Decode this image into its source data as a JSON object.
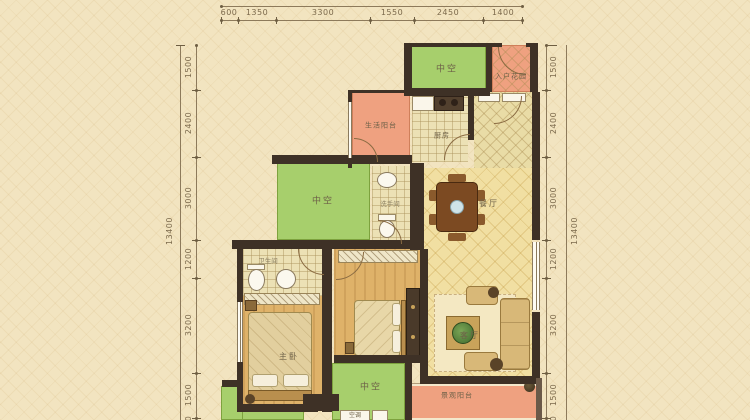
{
  "plan": {
    "dims": {
      "top": [
        "600",
        "1350",
        "3300",
        "1550",
        "2450",
        "1400"
      ],
      "left_total": "13400",
      "right_total": "13400",
      "left": [
        "1500",
        "2400",
        "3000",
        "1200",
        "3200",
        "1500",
        "600"
      ],
      "right": [
        "1500",
        "2400",
        "3000",
        "1200",
        "3200",
        "1500",
        "600"
      ]
    },
    "rooms": {
      "void_top": "中空",
      "entry_garden": "入户花园",
      "service_balcony": "生活阳台",
      "kitchen": "厨房",
      "void_mid": "中空",
      "wc": "洗手间",
      "dining": "餐厅",
      "bath": "卫生间",
      "master": "主卧",
      "living": "客厅",
      "void_bottom": "中空",
      "view_balcony": "景观阳台",
      "ac": "空调"
    },
    "colors": {
      "void_green": "#a7cf6c",
      "balcony_orange": "#efa180",
      "wall": "#3e3126",
      "background": "#f2e4c0"
    }
  }
}
